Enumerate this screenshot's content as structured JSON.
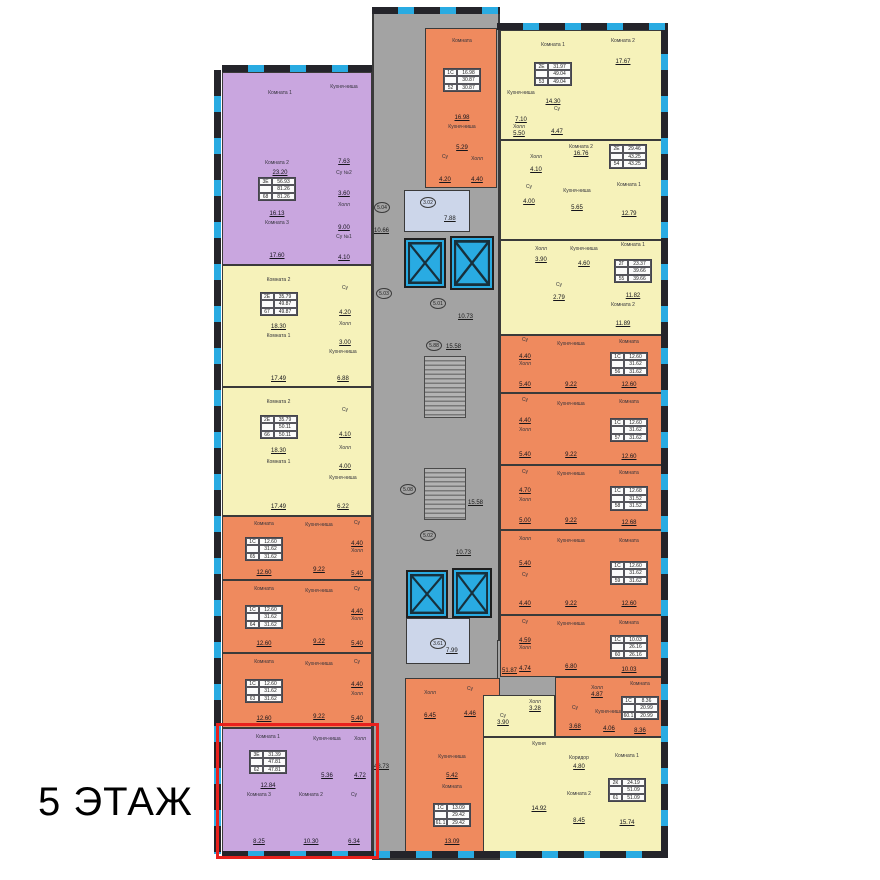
{
  "floor_label": "5 ЭТАЖ",
  "colors": {
    "three_room": "#c9a6df",
    "two_room": "#f6f2ba",
    "one_room": "#ef8a5e",
    "common_area": "#a3a3a3",
    "vestibule": "#ccd6ea",
    "window": "#29abe2",
    "wall": "#3a3a3a",
    "highlight": "#e8211d"
  },
  "apartments": [
    {
      "num": "68",
      "type": "3Е",
      "living": "56.93",
      "total": "81.26",
      "rooms": [
        {
          "name": "Комната 1",
          "area": "23.20"
        },
        {
          "name": "Кухня-ниша",
          "area": "7.63"
        },
        {
          "name": "Су №2",
          "area": "3.60"
        },
        {
          "name": "Комната 2",
          "area": "16.13"
        },
        {
          "name": "Холл",
          "area": "9.00"
        },
        {
          "name": "Комната 3",
          "area": "17.60"
        },
        {
          "name": "Су №1",
          "area": "4.10"
        }
      ]
    },
    {
      "num": "67",
      "type": "2Е",
      "living": "35.79",
      "total": "49.87",
      "rooms": [
        {
          "name": "Комната 2",
          "area": "18.30"
        },
        {
          "name": "Су",
          "area": "4.20"
        },
        {
          "name": "Холл",
          "area": "3.00"
        },
        {
          "name": "Комната 1",
          "area": "17.49"
        },
        {
          "name": "Кухня-ниша",
          "area": "6.88"
        }
      ]
    },
    {
      "num": "66",
      "type": "2Е",
      "living": "35.79",
      "total": "50.11",
      "rooms": [
        {
          "name": "Комната 2",
          "area": "18.30"
        },
        {
          "name": "Су",
          "area": "4.10"
        },
        {
          "name": "Холл",
          "area": "4.00"
        },
        {
          "name": "Комната 1",
          "area": "17.49"
        },
        {
          "name": "Кухня-ниша",
          "area": "6.22"
        }
      ]
    },
    {
      "num": "65",
      "type": "1С",
      "living": "12.60",
      "total": "31.62",
      "rooms": [
        {
          "name": "Комната",
          "area": "12.60"
        },
        {
          "name": "Кухня-ниша",
          "area": "9.22"
        },
        {
          "name": "Су",
          "area": "4.40"
        },
        {
          "name": "Холл",
          "area": "5.40"
        }
      ]
    },
    {
      "num": "64",
      "type": "1С",
      "living": "12.60",
      "total": "31.62",
      "rooms": [
        {
          "name": "Комната",
          "area": "12.60"
        },
        {
          "name": "Кухня-ниша",
          "area": "9.22"
        },
        {
          "name": "Су",
          "area": "4.40"
        },
        {
          "name": "Холл",
          "area": "5.40"
        }
      ]
    },
    {
      "num": "63",
      "type": "1С",
      "living": "12.60",
      "total": "31.62",
      "rooms": [
        {
          "name": "Комната",
          "area": "12.60"
        },
        {
          "name": "Кухня-ниша",
          "area": "9.22"
        },
        {
          "name": "Су",
          "area": "4.40"
        },
        {
          "name": "Холл",
          "area": "5.40"
        }
      ]
    },
    {
      "num": "62",
      "type": "3Е",
      "living": "31.39",
      "total": "47.81",
      "rooms": [
        {
          "name": "Комната 1",
          "area": "12.84"
        },
        {
          "name": "Кухня-ниша",
          "area": "5.36"
        },
        {
          "name": "Холл",
          "area": "4.72"
        },
        {
          "name": "Комната 3",
          "area": "8.25"
        },
        {
          "name": "Комната 2",
          "area": "10.30"
        },
        {
          "name": "Су",
          "area": "6.34"
        }
      ]
    },
    {
      "num": "52",
      "type": "1С",
      "living": "16.98",
      "total": "30.87",
      "rooms": [
        {
          "name": "Комната",
          "area": "16.98"
        },
        {
          "name": "Кухня-ниша",
          "area": "5.29"
        },
        {
          "name": "Су",
          "area": "4.20"
        },
        {
          "name": "Холл",
          "area": "4.40"
        }
      ]
    },
    {
      "num": "53",
      "type": "2Е",
      "living": "31.97",
      "total": "49.04",
      "rooms": [
        {
          "name": "Комната 1",
          "area": "14.30"
        },
        {
          "name": "Комната 2",
          "area": "17.67"
        },
        {
          "name": "Кухня-ниша",
          "area": "7.10"
        },
        {
          "name": "Су",
          "area": "4.47"
        },
        {
          "name": "Холл",
          "area": "5.50"
        }
      ]
    },
    {
      "num": "54",
      "type": "2Е",
      "living": "29.46",
      "total": "43.25",
      "rooms": [
        {
          "name": "Комната 2",
          "area": "16.76"
        },
        {
          "name": "Холл",
          "area": "4.10"
        },
        {
          "name": "Су",
          "area": "4.00"
        },
        {
          "name": "Кухня-ниша",
          "area": "5.65"
        },
        {
          "name": "Комната 1",
          "area": "12.79"
        }
      ]
    },
    {
      "num": "55",
      "type": "2Г",
      "living": "23.37",
      "total": "39.66",
      "rooms": [
        {
          "name": "Холл",
          "area": "3.90"
        },
        {
          "name": "Кухня-ниша",
          "area": "4.60"
        },
        {
          "name": "Комната 1",
          "area": "11.82"
        },
        {
          "name": "Су",
          "area": "2.79"
        },
        {
          "name": "Комната 2",
          "area": "11.89"
        }
      ]
    },
    {
      "num": "56",
      "type": "1С",
      "living": "12.60",
      "total": "31.62",
      "rooms": [
        {
          "name": "Су",
          "area": "4.40"
        },
        {
          "name": "Холл",
          "area": "5.40"
        },
        {
          "name": "Кухня-ниша",
          "area": "9.22"
        },
        {
          "name": "Комната",
          "area": "12.60"
        }
      ]
    },
    {
      "num": "57",
      "type": "1С",
      "living": "12.60",
      "total": "31.62",
      "rooms": [
        {
          "name": "Су",
          "area": "4.40"
        },
        {
          "name": "Холл",
          "area": "5.40"
        },
        {
          "name": "Кухня-ниша",
          "area": "9.22"
        },
        {
          "name": "Комната",
          "area": "12.60"
        }
      ]
    },
    {
      "num": "58",
      "type": "1С",
      "living": "12.68",
      "total": "31.52",
      "rooms": [
        {
          "name": "Су",
          "area": "4.70"
        },
        {
          "name": "Холл",
          "area": "5.00"
        },
        {
          "name": "Кухня-ниша",
          "area": "9.22"
        },
        {
          "name": "Комната",
          "area": "12.68"
        }
      ]
    },
    {
      "num": "59",
      "type": "1С",
      "living": "12.60",
      "total": "31.62",
      "rooms": [
        {
          "name": "Холл",
          "area": "5.40"
        },
        {
          "name": "Су",
          "area": "4.40"
        },
        {
          "name": "Кухня-ниша",
          "area": "9.22"
        },
        {
          "name": "Комната",
          "area": "12.60"
        }
      ]
    },
    {
      "num": "60",
      "type": "1С",
      "living": "10.03",
      "total": "26.16",
      "rooms": [
        {
          "name": "Су",
          "area": "4.59"
        },
        {
          "name": "Холл",
          "area": "4.74"
        },
        {
          "name": "Кухня-ниша",
          "area": "6.80"
        },
        {
          "name": "Комната",
          "area": "10.03"
        }
      ]
    },
    {
      "num": "60.1",
      "type": "1С",
      "living": "8.36",
      "total": "20.99",
      "rooms": [
        {
          "name": "Холл",
          "area": "4.87"
        },
        {
          "name": "Су",
          "area": "3.68"
        },
        {
          "name": "Кухня-ниша",
          "area": "4.06"
        },
        {
          "name": "Комната",
          "area": "8.36"
        }
      ]
    },
    {
      "num": "61.1",
      "type": "1С",
      "living": "13.09",
      "total": "29.42",
      "rooms": [
        {
          "name": "Холл",
          "area": "6.45"
        },
        {
          "name": "Су",
          "area": "4.46"
        },
        {
          "name": "Кухня-ниша",
          "area": "5.42"
        },
        {
          "name": "Комната",
          "area": "13.09"
        }
      ]
    },
    {
      "num": "61",
      "type": "2К",
      "living": "24.19",
      "total": "51.09",
      "rooms": [
        {
          "name": "Холл",
          "area": "3.28"
        },
        {
          "name": "Су",
          "area": "3.90"
        },
        {
          "name": "Кухня",
          "area": "14.92"
        },
        {
          "name": "Коридор",
          "area": "4.80"
        },
        {
          "name": "Комната 2",
          "area": "8.45"
        },
        {
          "name": "Комната 1",
          "area": "15.74"
        }
      ]
    }
  ],
  "common_areas": {
    "circled": [
      "5.04",
      "3.02",
      "5.03",
      "5.01",
      "5.88",
      "5.08",
      "5.02",
      "3.61"
    ],
    "labels": [
      "10.66",
      "7.88",
      "10.73",
      "15.58",
      "15.58",
      "10.73",
      "7.99",
      "48.73",
      "51.87"
    ]
  }
}
